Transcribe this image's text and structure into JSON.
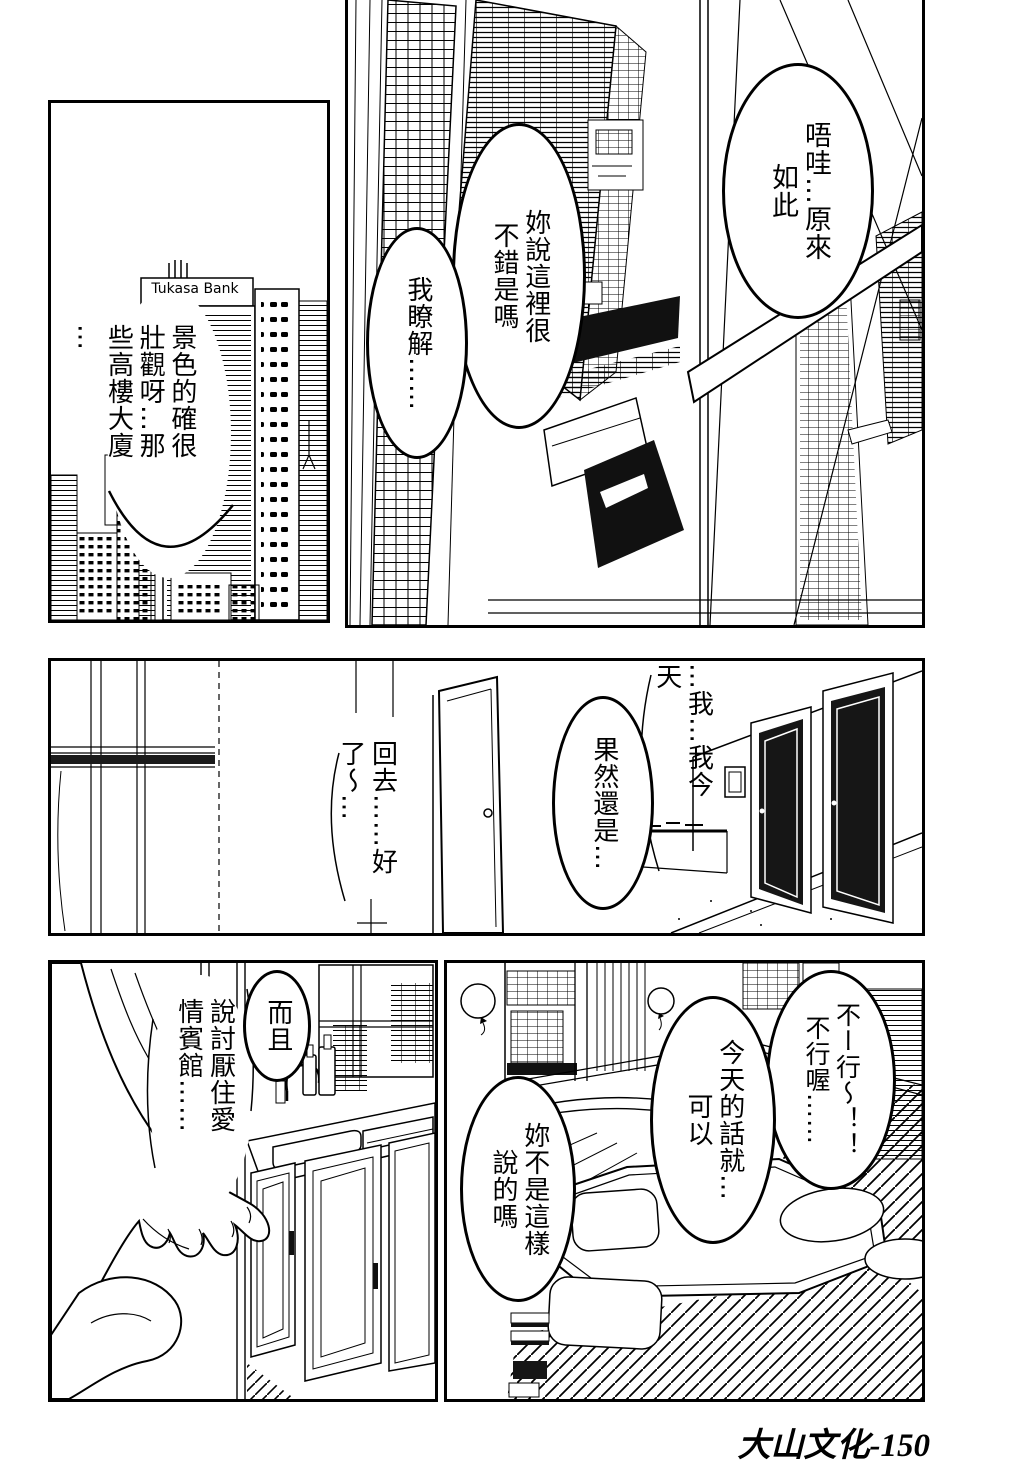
{
  "page": {
    "caption": "大山文化-150"
  },
  "panel_top_left": {
    "monologue_view": "景色的確很\n壯觀呀…那\n些高樓大廈\n…",
    "bank_sign": "Tukasa Bank"
  },
  "panel_top_right": {
    "bubble_understand": "唔哇…原來\n如此",
    "bubble_nice_here": "妳說這裡很\n不錯是嗎",
    "bubble_i_know": "我瞭解……"
  },
  "panel_hallway": {
    "monologue_today": "…我…我今\n天",
    "bubble_after_all": "果然還是…",
    "monologue_go_home": "回去……好\n了～…"
  },
  "panel_kitchen": {
    "bubble_besides": "而且",
    "monologue_hotel": "說討厭住愛\n情賓館……"
  },
  "panel_room": {
    "bubble_no_way": "不ー行～！！\n不行喔……",
    "bubble_today_ok": "今天的話就…\n可以",
    "bubble_you_said": "妳不是這樣\n說的嗎"
  }
}
